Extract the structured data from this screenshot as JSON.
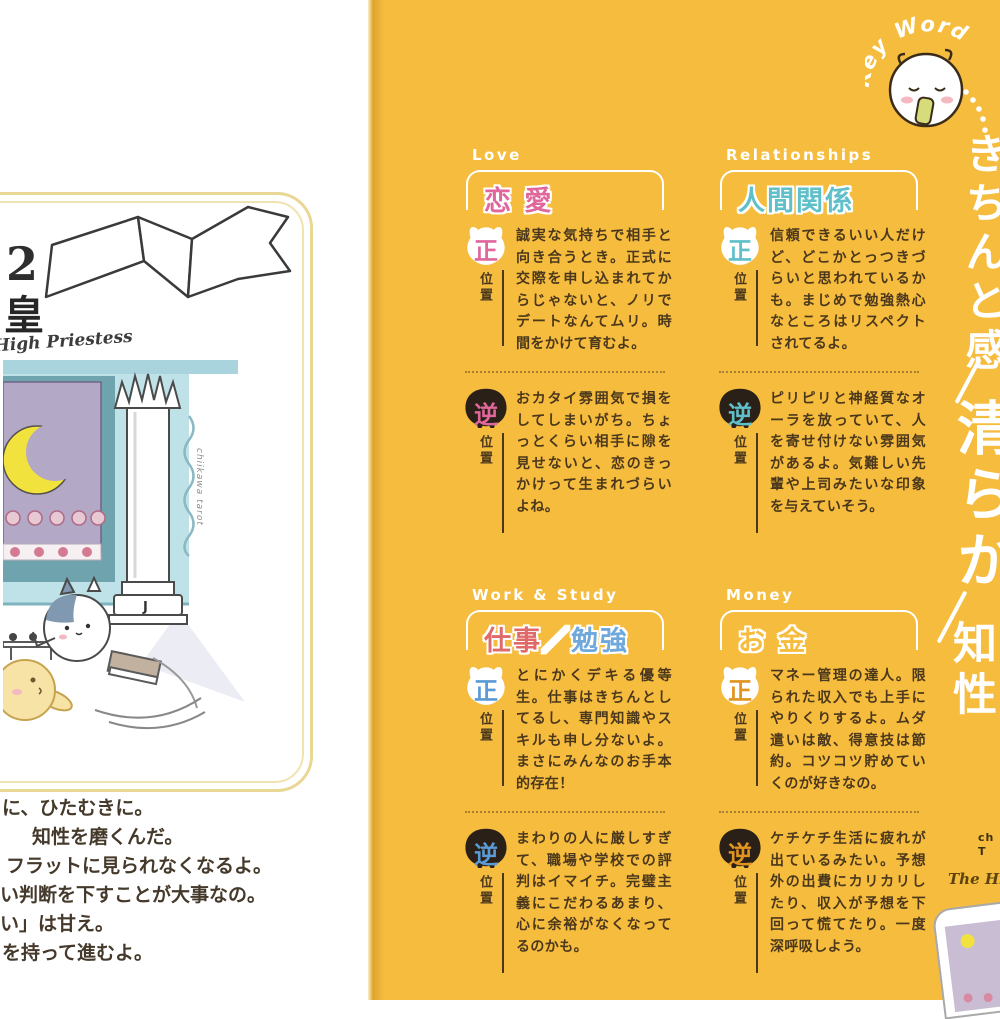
{
  "palette": {
    "page_yellow": "#F6BC3E",
    "spine_shadow": "#DFA42E",
    "text_brown": "#4A371C",
    "accent_love": "#E0679C",
    "accent_relationships": "#5FC0C9",
    "accent_work_blue": "#5B9BD5",
    "accent_work_red": "#E06A6A",
    "accent_money": "#E1941F",
    "card_border_tan": "#E8D795"
  },
  "left_page": {
    "card": {
      "number": "2",
      "title_jp": "女教皇",
      "title_en_script": "The High Priestess",
      "credit_vertical": "chiikawa tarot",
      "column_letter": "J"
    },
    "bottom_text_lines": [
      "に、ひたむきに。",
      "知性を磨くんだ。",
      "フラットに見られなくなるよ。",
      "い判断を下すことが大事なの。",
      "い」は甘え。",
      "を持って進むよ。"
    ]
  },
  "right_page": {
    "keyword_label": "Key Word",
    "keywords": [
      "きちんと感",
      "清らか",
      "知性"
    ],
    "position_label": "位置",
    "upright_char": "正",
    "reversed_char": "逆",
    "sections": [
      {
        "label_en": "Love",
        "label_jp": "恋 愛",
        "upright_text": "誠実な気持ちで相手と向き合うとき。正式に交際を申し込まれてからじゃないと、ノリでデートなんてムリ。時間をかけて育むよ。",
        "reversed_text": "おカタイ雰囲気で損をしてしまいがち。ちょっとくらい相手に隙を見せないと、恋のきっかけって生まれづらいよね。"
      },
      {
        "label_en": "Relationships",
        "label_jp": "人間関係",
        "upright_text": "信頼できるいい人だけど、どこかとっつきづらいと思われているかも。まじめで勉強熱心なところはリスペクトされてるよ。",
        "reversed_text": "ピリピリと神経質なオーラを放っていて、人を寄せ付けない雰囲気があるよ。気難しい先輩や上司みたいな印象を与えていそう。"
      },
      {
        "label_en": "Work & Study",
        "label_jp": "仕事／勉強",
        "label_jp_a": "仕事",
        "label_jp_slash": "／",
        "label_jp_b": "勉強",
        "upright_text": "とにかくデキる優等生。仕事はきちんとしてるし、専門知識やスキルも申し分ないよ。まさにみんなのお手本的存在！",
        "reversed_text": "まわりの人に厳しすぎて、職場や学校での評判はイマイチ。完璧主義にこだわるあまり、心に余裕がなくなってるのかも。"
      },
      {
        "label_en": "Money",
        "label_jp": "お 金",
        "upright_text": "マネー管理の達人。限られた収入でも上手にやりくりするよ。ムダ遣いは敵、得意技は節約。コツコツ貯めていくのが好きなの。",
        "reversed_text": "ケチケチ生活に疲れが出ているみたい。予想外の出費にカリカリしたり、収入が予想を下回って慌てたり。一度深呼吸しよう。"
      }
    ],
    "corner": {
      "brand_line1": "ch",
      "brand_line2": "T",
      "caption_script": "The High Priestess"
    }
  }
}
